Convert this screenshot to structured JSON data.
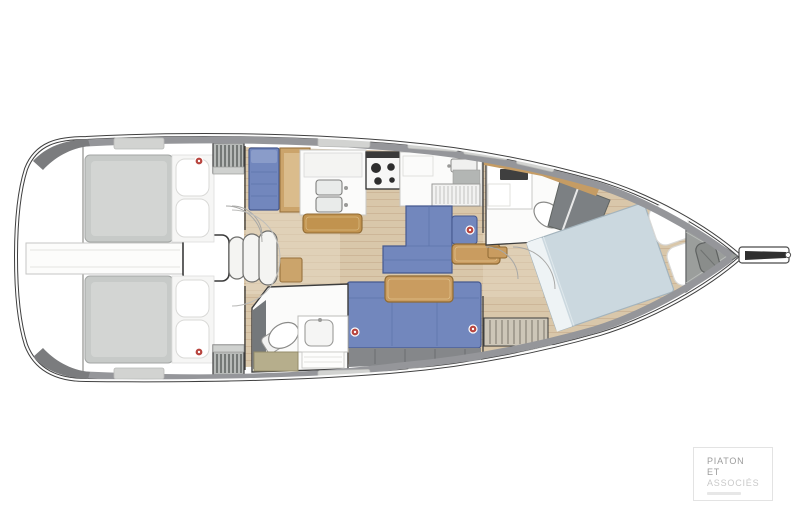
{
  "image": {
    "width": 800,
    "height": 528,
    "background": "#ffffff"
  },
  "figure": {
    "kind": "sailboat-interior-floor-plan",
    "orientation": "bow-right",
    "rooms": [
      "aft-cabin-port",
      "aft-cabin-starboard",
      "companionway-steps",
      "salon",
      "galley",
      "aft-head",
      "forward-head",
      "forward-cabin",
      "anchor-locker"
    ],
    "palette": {
      "hull_line": "#3f3f3f",
      "deck_band": "#95969a",
      "deck_corner": "#7b7c7e",
      "hatch": "#d2d3d1",
      "floor_wood": "#d9c7aa",
      "floor_seam": "#cab293",
      "furniture_wood": "#c99c60",
      "upholstery_blue": "#7287bd",
      "upholstery_blue_dark": "#46598f",
      "mattress_gray": "#c7cac8",
      "blanket_blue_gray": "#cbd8df",
      "shower_gray": "#7c8083",
      "khaki_bench": "#b6ae8c",
      "knob_red": "#b8453f",
      "anchor_zone": "#9b9e9c"
    }
  },
  "watermark": {
    "line1": "PIATON",
    "line2": "ET",
    "line3": "ASSOCIÉS",
    "border_color": "#e3e3e3",
    "text_color": "#9c9c9c",
    "muted_color": "#c9c9c9"
  }
}
